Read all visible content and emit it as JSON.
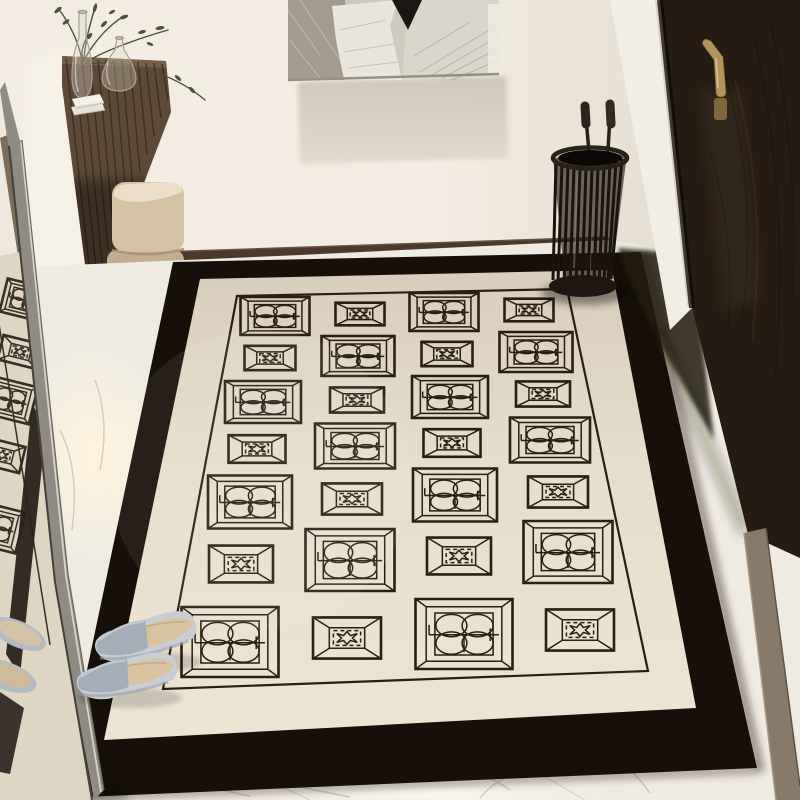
{
  "meta": {
    "title": "Entryway interior product photo",
    "subject": "Black-and-cream Chinese lattice pattern entry rug in a hallway",
    "style": "3D rendered product scene, no visible text"
  },
  "colors": {
    "wall": "#f2ece2",
    "wall_shade": "#e4ded2",
    "baseboard": "#4b3a2c",
    "floor": "#efebe2",
    "floor_glow": "#fdf4e0",
    "rug_border": "#17100a",
    "rug_field": "#ece3d2",
    "rug_line": "#281e14",
    "door": "#261b12",
    "door_trim": "#f3eee5",
    "handle_brass": "#b3945c",
    "threshold": "#877a69",
    "wood": "#5d4936",
    "mirror_frame": "#8f8b82",
    "glass_white": "#f2ede3",
    "ottoman": "#d5c1a4",
    "stand": "#1e1711",
    "plant": "#4d5038",
    "glass_stroke": "#a8a296",
    "slipper_strap": "#a5aeb8",
    "slipper_sole": "#c9cdd2",
    "slipper_insole": "#d8c2a0",
    "art_left": "#a49a8d",
    "art_white": "#eae6de",
    "art_black": "#1b1713",
    "art_right": "#dbd6cb"
  },
  "rug": {
    "label": "entry area rug",
    "rows": 7,
    "columns": 4,
    "motif_a": "double-coin medallion",
    "motif_b": "lattice star medallion",
    "layout": "checkerboard alternation of motifs inside beveled frames, heavy black outer border"
  },
  "objects": {
    "mirror": "leaning full-length mirror reflecting rug and slippers",
    "artwork": "abstract beige/white/black canvas",
    "console": "floating dark walnut wall console",
    "plant": "dried olive branches in glass bottle vase",
    "flask": "round glass terrarium",
    "books": "two white books",
    "ottoman": "stacked beige leather ottoman",
    "door": "dark walnut entry door with brass lever handle",
    "umbrella_stand": "black wire cylinder umbrella stand with two umbrellas",
    "slippers": "pair of grey open-toe slippers",
    "floor": "white marble tile floor"
  }
}
